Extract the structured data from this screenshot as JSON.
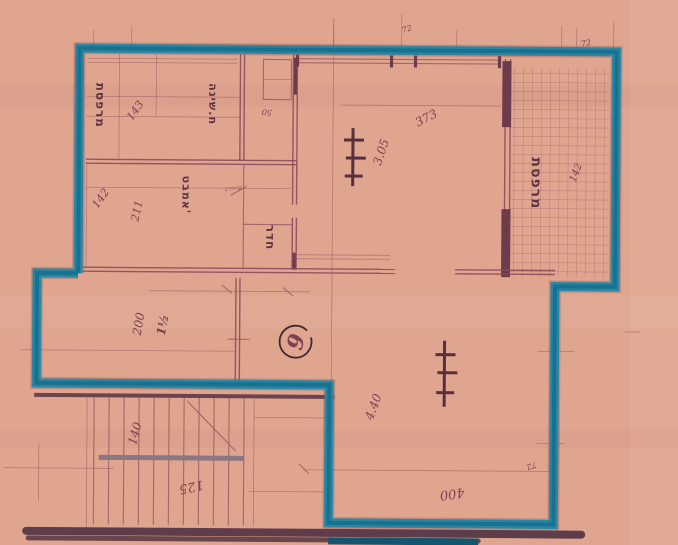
{
  "document": {
    "kind": "scanned architectural floor plan",
    "unit_circle_number": "6"
  },
  "room_labels": {
    "left_strip": "מרפסת",
    "bedroom": "ח.שינה",
    "bathroom": "אמבט'",
    "inner_room": "חדר",
    "balcony": "מרפסת",
    "small_note": "שרותים"
  },
  "dimensions": {
    "d143": "143",
    "d50": "50",
    "d142": "142",
    "d211": "211",
    "d200": "200",
    "d_half": "1½",
    "d305": "3.05",
    "d373": "373",
    "d440": "4.40",
    "d400": "400",
    "d140": "140",
    "d125": "125",
    "d72a": "72",
    "d72b": "72",
    "d72c": "72",
    "d142_balcony": "142"
  },
  "colors": {
    "paper": "#dfa58f",
    "wall_teal": "#1f7e9d",
    "line_maroon": "#9a5a64",
    "dark_maroon": "#5c3242"
  }
}
